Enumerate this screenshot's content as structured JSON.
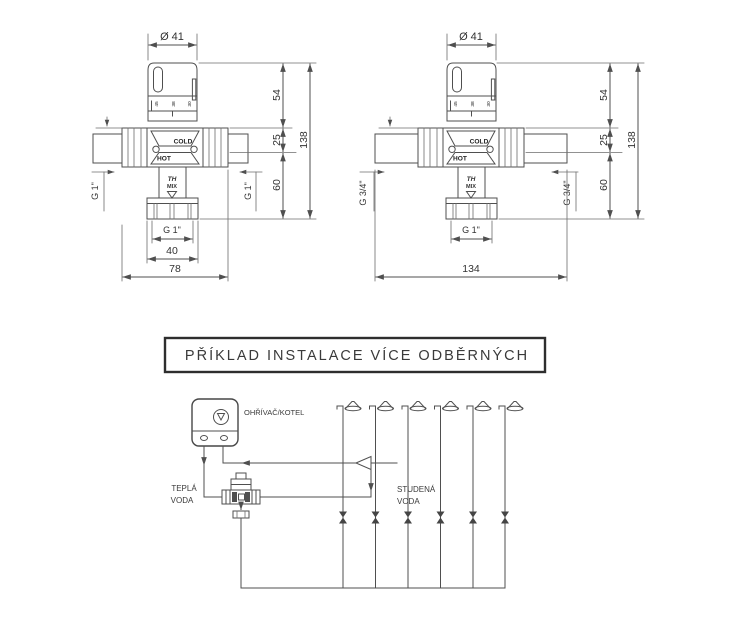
{
  "drawing": {
    "background": "#ffffff",
    "line_color": "#4f4f4f",
    "text_color": "#333333"
  },
  "valve_left": {
    "diameter_label": "Ø 41",
    "scale_marks": [
      "45",
      "38",
      "30"
    ],
    "body_labels": {
      "cold": "COLD",
      "hot": "HOT",
      "mix_line1": "TH",
      "mix_line2": "MIX"
    },
    "dimensions": {
      "knob_height": "54",
      "upper_offset": "25",
      "lower_height": "60",
      "total_height": "138",
      "inlet_left": "G 1\"",
      "inlet_right": "G 1\"",
      "outlet": "G 1\"",
      "outlet_width": "40",
      "body_width": "78"
    }
  },
  "valve_right": {
    "diameter_label": "Ø 41",
    "scale_marks": [
      "45",
      "38",
      "30"
    ],
    "body_labels": {
      "cold": "COLD",
      "hot": "HOT",
      "mix_line1": "TH",
      "mix_line2": "MIX"
    },
    "dimensions": {
      "knob_height": "54",
      "upper_offset": "25",
      "lower_height": "60",
      "total_height": "138",
      "inlet_left": "G 3/4\"",
      "inlet_right": "G 3/4\"",
      "outlet": "G 1\"",
      "body_width": "134"
    }
  },
  "installation": {
    "title": "PŘÍKLAD INSTALACE VÍCE ODBĚRNÝCH",
    "boiler_label": "OHŘÍVAČ/KOTEL",
    "hot_water_label": {
      "line1": "TEPLÁ",
      "line2": "VODA"
    },
    "cold_water_label": {
      "line1": "STUDENÁ",
      "line2": "VODA"
    },
    "shower_count": 6
  }
}
